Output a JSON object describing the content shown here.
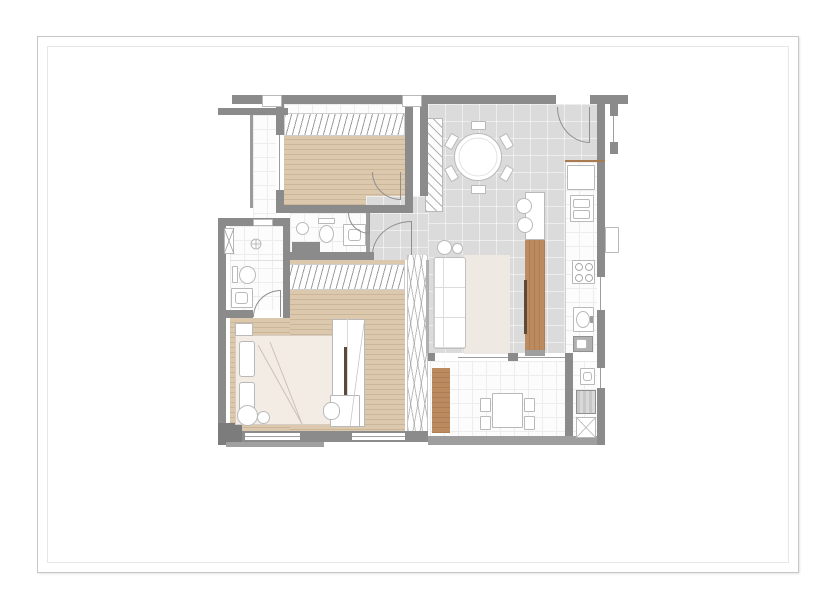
{
  "palette": {
    "paper": "#ffffff",
    "frame_outer": "#c6c6c6",
    "frame_inner": "#e7e7e7",
    "wall": "#8b8b8b",
    "wall_light": "#b5b5b5",
    "wall_dark": "#7c7c7c",
    "wood_floor": "#dbc8ad",
    "tile_gray": "#dbdbdc",
    "white_floor": "#fcfcfc",
    "grid_line": "#ededed",
    "wood_furniture": "#bc8a5f",
    "wood_dark": "#5d4a36",
    "rug": "#efe9e3",
    "bed_linen": "#f2ece5",
    "outline": "#b9b9b9",
    "counter_edge": "#a87c50"
  },
  "floor_plan": {
    "drawing_type": "apartment floor plan (no text labels or dimensions printed)",
    "rooms": [
      {
        "name": "bedroom-2",
        "floor": "wood",
        "features": [
          "wardrobe-hatch",
          "window",
          "door"
        ]
      },
      {
        "name": "dining-area",
        "floor": "gray-tile",
        "features": [
          "round-table-6-chairs",
          "entry-door",
          "mirror-panel"
        ]
      },
      {
        "name": "living-area",
        "floor": "gray-tile",
        "features": [
          "sofa",
          "rug",
          "island-tv-column",
          "bar-stools"
        ]
      },
      {
        "name": "kitchen-run",
        "floor": "white",
        "features": [
          "fridge",
          "cooktop-4-burners",
          "sink",
          "dark-counter-sink"
        ]
      },
      {
        "name": "hall-corridor",
        "floor": "gray-tile",
        "features": [
          "doors-to-bath-and-bedroom"
        ]
      },
      {
        "name": "bathroom",
        "floor": "white",
        "features": [
          "wall-sink",
          "toilet",
          "vanity"
        ]
      },
      {
        "name": "ensuite-bathroom",
        "floor": "white",
        "features": [
          "shower",
          "toilet",
          "vanity",
          "duct-shaft"
        ]
      },
      {
        "name": "master-bedroom",
        "floor": "wood",
        "features": [
          "double-bed",
          "wardrobe-hatch",
          "tv-panel",
          "desk-chair",
          "sliding-wardrobe"
        ]
      },
      {
        "name": "balcony-terrace",
        "floor": "white",
        "features": [
          "deck-boards",
          "table-4-chairs"
        ]
      },
      {
        "name": "laundry",
        "floor": "white",
        "features": [
          "cabinet",
          "washing-machine",
          "tank"
        ]
      },
      {
        "name": "exterior-courtyard",
        "floor": "white-tile",
        "features": []
      }
    ],
    "openings": {
      "swing_doors": 5,
      "windows": [
        "bedroom-2-west",
        "master-bottom-1",
        "master-bottom-2",
        "kitchen-east",
        "laundry-east",
        "entry-stub"
      ]
    }
  }
}
